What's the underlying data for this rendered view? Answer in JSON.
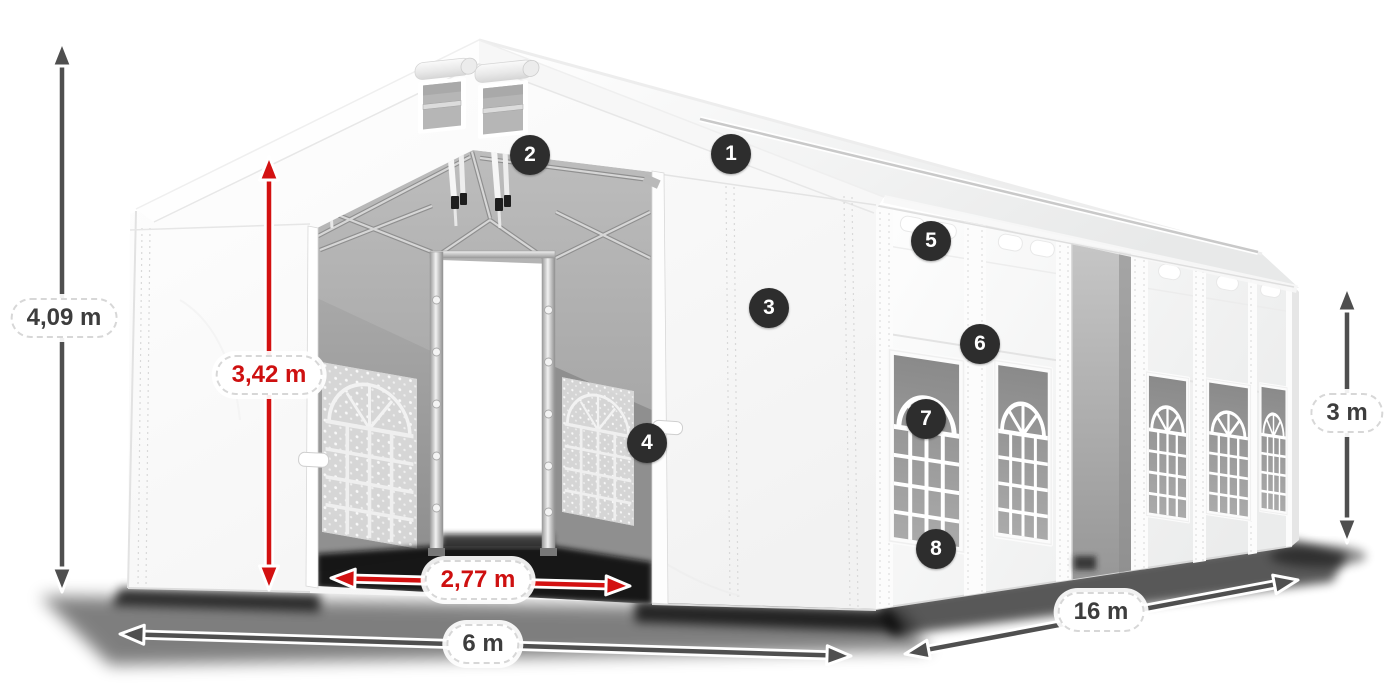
{
  "diagram": {
    "name": "Tent dimensions diagram",
    "dimensions": {
      "total_height": {
        "label": "4,09 m",
        "style": "dark"
      },
      "entrance_height": {
        "label": "3,42 m",
        "style": "red"
      },
      "entrance_width": {
        "label": "2,77 m",
        "style": "red"
      },
      "front_width": {
        "label": "6 m",
        "style": "dark"
      },
      "side_length": {
        "label": "16 m",
        "style": "dark"
      },
      "side_wall_height": {
        "label": "3 m",
        "style": "dark"
      }
    },
    "callouts": [
      {
        "number": "1"
      },
      {
        "number": "2"
      },
      {
        "number": "3"
      },
      {
        "number": "4"
      },
      {
        "number": "5"
      },
      {
        "number": "6"
      },
      {
        "number": "7"
      },
      {
        "number": "8"
      }
    ],
    "colors": {
      "dimension_dark": "#4f4f4f",
      "dimension_red": "#d31111",
      "label_text_dark": "#3d3d3d",
      "label_text_red": "#ce1010",
      "badge_background": "#2d2d2d",
      "badge_text": "#ffffff",
      "tent_fabric": "#ffffff",
      "background": "#ffffff"
    }
  }
}
